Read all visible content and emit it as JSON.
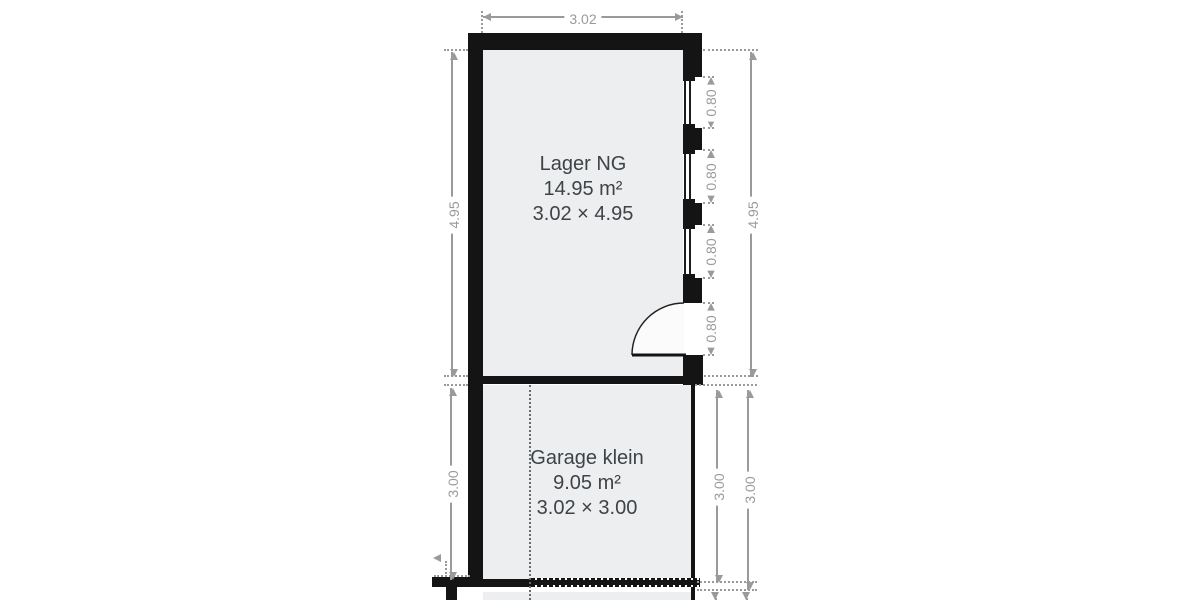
{
  "rooms": [
    {
      "name": "Lager NG",
      "area": "14.95 m²",
      "size": "3.02 × 4.95"
    },
    {
      "name": "Garage klein",
      "area": "9.05 m²",
      "size": "3.02 × 3.00"
    }
  ],
  "dimensions": {
    "top_width": "3.02",
    "upper_left": "4.95",
    "upper_right": "4.95",
    "lower_left": "3.00",
    "lower_right_inner": "3.00",
    "lower_right_outer": "3.00",
    "window_top": "0.80",
    "window_middle": "0.80",
    "window_bottom": "0.80",
    "door": "0.80"
  },
  "colors": {
    "wall": "#141414",
    "floor": "#edeeef",
    "dim": "#9a9a9a",
    "label_text": "#3e4347"
  }
}
